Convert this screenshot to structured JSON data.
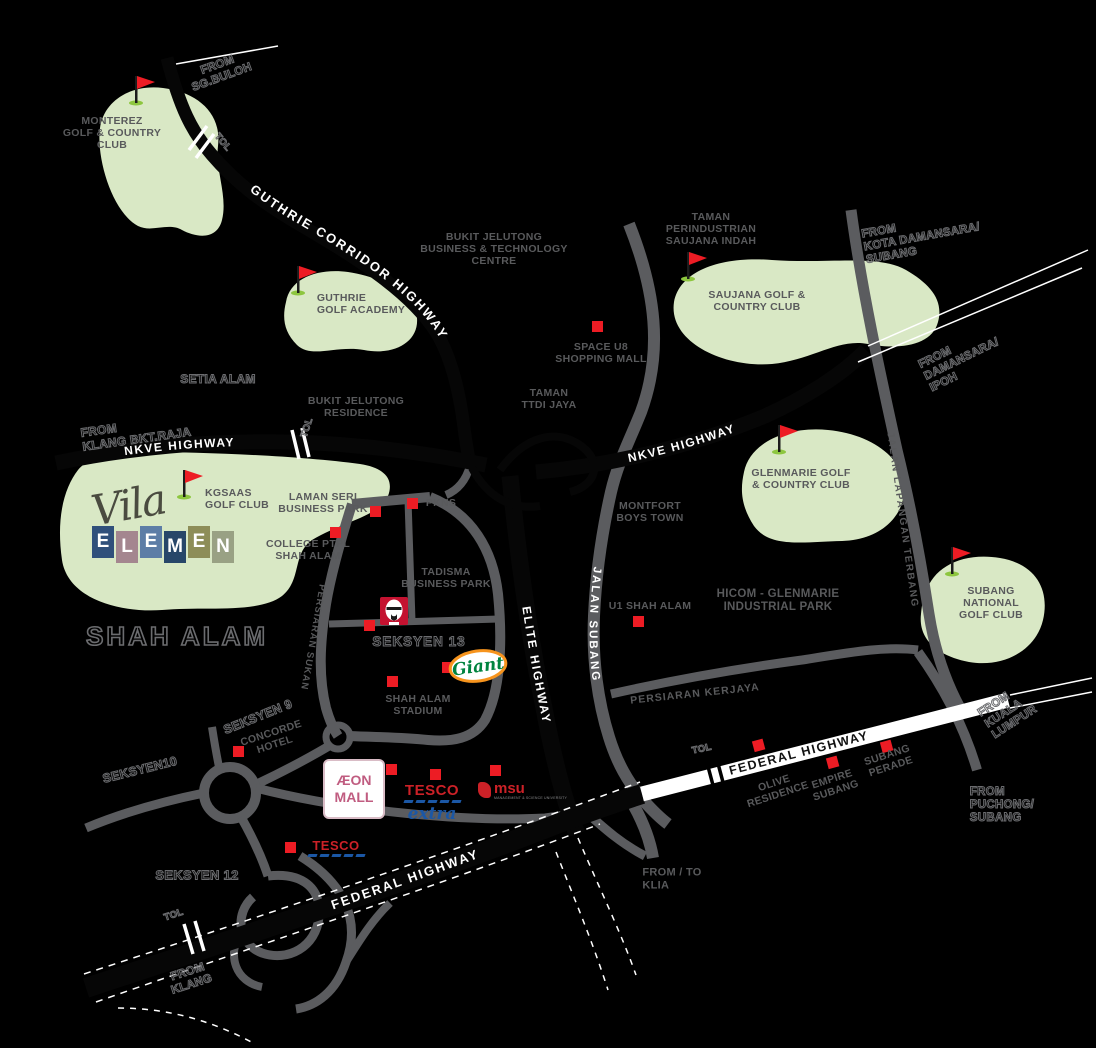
{
  "region": {
    "title": "SHAH ALAM"
  },
  "logo": {
    "script": "Vila",
    "letters": [
      "E",
      "L",
      "E",
      "M",
      "E",
      "N"
    ],
    "tile_styles": [
      "background:#30507b",
      "background:#a4868f",
      "background:#5d7da6",
      "background:#274669",
      "background:#8d8d58",
      "background:#99a184"
    ]
  },
  "golf": {
    "monterez": "MONTEREZ\nGOLF & COUNTRY\nCLUB",
    "guthrie_academy": "GUTHRIE\nGOLF ACADEMY",
    "saujana": "SAUJANA GOLF &\nCOUNTRY CLUB",
    "kgsaas": "KGSAAS\nGOLF CLUB",
    "glenmarie": "GLENMARIE GOLF\n& COUNTRY CLUB",
    "subang_national": "SUBANG NATIONAL\nGOLF CLUB"
  },
  "places": {
    "bukit_jelutong_btc": "BUKIT JELUTONG\nBUSINESS & TECHNOLOGY\nCENTRE",
    "setia_alam": "SETIA ALAM",
    "bukit_jelutong_res": "BUKIT JELUTONG\nRESIDENCE",
    "taman_perindustrian": "TAMAN\nPERINDUSTRIAN\nSAUJANA INDAH",
    "space_u8": "SPACE U8\nSHOPPING MALL",
    "taman_ttdi": "TAMAN\nTTDI JAYA",
    "laman_seri": "LAMAN SERI\nBUSINESS PARK",
    "pkns": "PKNS",
    "college": "COLLEGE PTPL\nSHAH ALAM",
    "tadisma": "TADISMA\nBUSINESS PARK",
    "montfort": "MONTFORT\nBOYS TOWN",
    "u1": "U1 SHAH ALAM",
    "hicom": "HICOM - GLENMARIE\nINDUSTRIAL PARK",
    "seksyen13": "SEKSYEN 13",
    "stadium": "SHAH ALAM\nSTADIUM",
    "seksyen9": "SEKSYEN 9",
    "concorde": "CONCORDE\nHOTEL",
    "seksyen10": "SEKSYEN10",
    "seksyen12": "SEKSYEN 12",
    "olive": "OLIVE\nRESIDENCE",
    "empire": "EMPIRE\nSUBANG",
    "subang_perade": "SUBANG\nPERADE"
  },
  "directions": {
    "sg_buloh": "FROM\nSG.BULOH",
    "kota_damansara": "FROM\nKOTA DAMANSARA/\nSUBANG",
    "damansara_ipoh": "FROM\nDAMANSARA/\nIPOH",
    "klang_bkt_raja": "FROM\nKLANG BKT.RAJA",
    "kuala_lumpur": "FROM\nKUALA\nLUMPUR",
    "puchong": "FROM\nPUCHONG/\nSUBANG",
    "klia": "FROM / TO\nKLIA",
    "klang": "FROM\nKLANG"
  },
  "roads": {
    "guthrie": "GUTHRIE CORRIDOR HIGHWAY",
    "nkve": "NKVE HIGHWAY",
    "elite": "ELITE HIGHWAY",
    "federal": "FEDERAL HIGHWAY",
    "jalan_subang": "JALAN SUBANG",
    "kerjaya": "PERSIARAN KERJAYA",
    "sukan": "PERSIARAN SUKAN",
    "lapangan": "JALAN LAPANGAN TERBANG",
    "tol": "TOL"
  },
  "brands": {
    "giant": "Giant",
    "aeon": "ÆON",
    "aeon2": "MALL",
    "tesco": "TESCO",
    "extra": "extra",
    "msu": "msu",
    "msu_sub": "MANAGEMENT & SCIENCE UNIVERSITY"
  },
  "colors": {
    "green_patch": "#d9e8c5",
    "road_grey": "#5b5c5f",
    "marker_red": "#ed1c24",
    "text_grey": "#595a5c",
    "flag_red": "#ed1c24",
    "flag_base_green": "#8dc63f"
  }
}
